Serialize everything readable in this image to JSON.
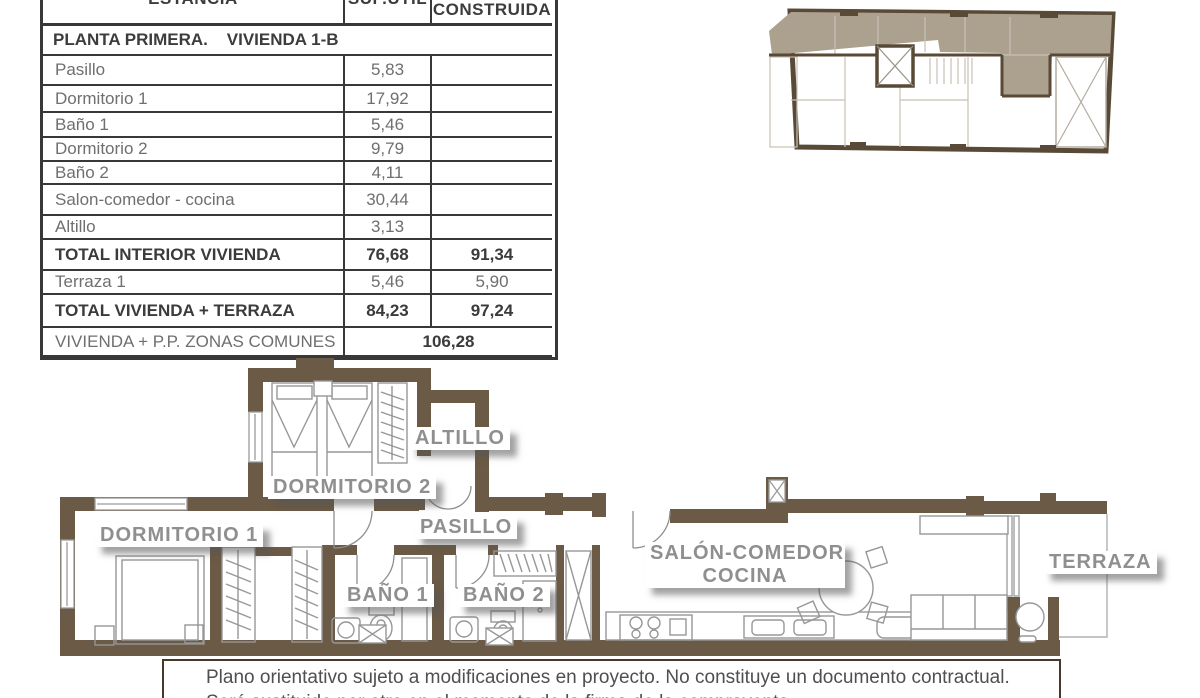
{
  "table": {
    "headers": {
      "estancia": "ESTANCIA",
      "sup_util": "SUP.ÚTIL",
      "construida": "CONSTRUIDA"
    },
    "section_title": "PLANTA PRIMERA.    VIVIENDA 1-B",
    "rows": [
      {
        "name": "Pasillo",
        "util": "5,83",
        "construida": ""
      },
      {
        "name": "Dormitorio 1",
        "util": "17,92",
        "construida": ""
      },
      {
        "name": "Baño 1",
        "util": "5,46",
        "construida": ""
      },
      {
        "name": "Dormitorio 2",
        "util": "9,79",
        "construida": ""
      },
      {
        "name": "Baño 2",
        "util": "4,11",
        "construida": ""
      },
      {
        "name": "Salon-comedor - cocina",
        "util": "30,44",
        "construida": ""
      },
      {
        "name": "Altillo",
        "util": "3,13",
        "construida": ""
      },
      {
        "name": "TOTAL INTERIOR VIVIENDA",
        "util": "76,68",
        "construida": "91,34"
      },
      {
        "name": "Terraza 1",
        "util": "5,46",
        "construida": "5,90"
      },
      {
        "name": "TOTAL VIVIENDA + TERRAZA",
        "util": "84,23",
        "construida": "97,24"
      }
    ],
    "footer": {
      "label": "VIVIENDA + P.P. ZONAS COMUNES",
      "value": "106,28"
    }
  },
  "floorplan": {
    "labels": {
      "dormitorio_2": "DORMITORIO 2",
      "altillo": "ALTILLO",
      "dormitorio_1": "DORMITORIO 1",
      "pasillo": "PASILLO",
      "bano_1": "BAÑO 1",
      "bano_2": "BAÑO 2",
      "salon_line1": "SALÓN-COMEDOR",
      "salon_line2": "COCINA",
      "terraza": "TERRAZA"
    },
    "colors": {
      "wall": "#6b5a45",
      "keyplan_wall": "#584a37",
      "keyplan_highlight": "#aca08f",
      "label_text": "#8f8f8f",
      "table_border": "#383838"
    }
  },
  "disclaimer": {
    "line1": "Plano orientativo sujeto a modificaciones en proyecto. No constituye un documento contractual.",
    "line2": "Será sustituido por otro en el momento de la firma de la compraventa."
  }
}
